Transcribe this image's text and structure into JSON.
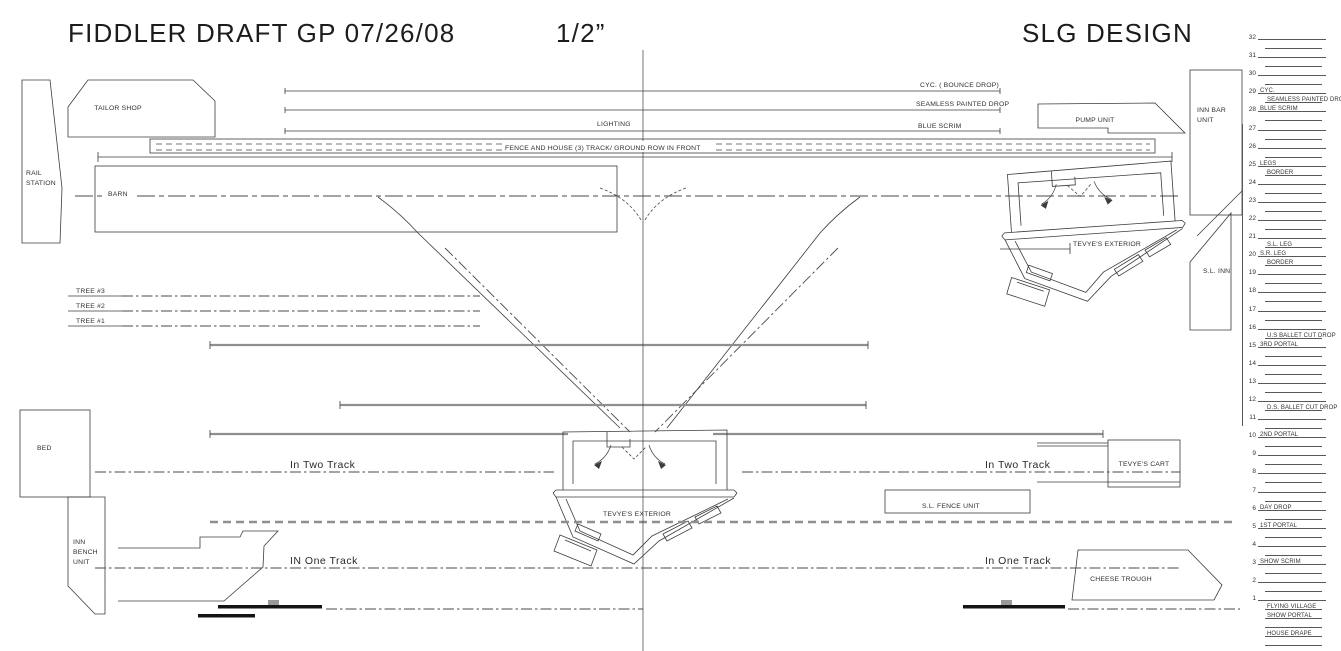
{
  "title_block": {
    "title": "FIDDLER DRAFT GP 07/26/08",
    "scale": "1/2”",
    "designer": "SLG DESIGN"
  },
  "labels": {
    "cyc_bounce_drop": "CYC. ( BOUNCE DROP)",
    "seamless_painted_drop": "SEAMLESS PAINTED DROP",
    "lighting": "LIGHTING",
    "blue_scrim": "BLUE SCRIM",
    "fence_house_track": "FENCE AND HOUSE (3)  TRACK/ GROUND ROW IN FRONT",
    "tailor_shop": "TAILOR SHOP",
    "rail_station_1": "RAIL",
    "rail_station_2": "STATION",
    "barn": "BARN",
    "tree_3": "TREE #3",
    "tree_2": "TREE #2",
    "tree_1": "TREE #1",
    "bed": "BED",
    "inn_bench_1": "INN",
    "inn_bench_2": "BENCH",
    "inn_bench_3": "UNIT",
    "in_two_track_left": "In Two Track",
    "in_two_track_right": "In Two Track",
    "in_one_track_left": "IN One Track",
    "in_one_track_right": "In One Track",
    "pump_unit": "PUMP UNIT",
    "inn_bar_unit_1": "INN BAR",
    "inn_bar_unit_2": "UNIT",
    "sl_inn": "S.L. INN",
    "tevyes_exterior_right": "TEVYE'S EXTERIOR",
    "tevyes_exterior_center": "TEVYE'S EXTERIOR",
    "tevyes_cart": "TEVYE'S CART",
    "sl_fence_unit": "S.L. FENCE UNIT",
    "cheese_trough": "CHEESE TROUGH"
  },
  "lineset_schedule": {
    "items": [
      {
        "n": "32"
      },
      {
        "s": 1
      },
      {
        "n": "31"
      },
      {
        "s": 1
      },
      {
        "n": "30"
      },
      {
        "s": 1
      },
      {
        "n": "29",
        "t": "CYC."
      },
      {
        "s": 1,
        "t": "SEAMLESS PAINTED DROP"
      },
      {
        "n": "28",
        "t": "BLUE SCRIM"
      },
      {
        "s": 1
      },
      {
        "n": "27"
      },
      {
        "s": 1
      },
      {
        "n": "26"
      },
      {
        "s": 1
      },
      {
        "n": "25",
        "t": "LEGS"
      },
      {
        "s": 1,
        "t": "BORDER"
      },
      {
        "n": "24"
      },
      {
        "s": 1
      },
      {
        "n": "23"
      },
      {
        "s": 1
      },
      {
        "n": "22"
      },
      {
        "s": 1
      },
      {
        "n": "21"
      },
      {
        "s": 1,
        "t": "S.L. LEG"
      },
      {
        "n": "20",
        "t": "S.R. LEG"
      },
      {
        "s": 1,
        "t": "BORDER"
      },
      {
        "n": "19"
      },
      {
        "s": 1
      },
      {
        "n": "18"
      },
      {
        "s": 1
      },
      {
        "n": "17"
      },
      {
        "s": 1
      },
      {
        "n": "16"
      },
      {
        "s": 1,
        "t": "U.S BALLET CUT DROP"
      },
      {
        "n": "15",
        "t": "3RD PORTAL"
      },
      {
        "s": 1
      },
      {
        "n": "14"
      },
      {
        "s": 1
      },
      {
        "n": "13"
      },
      {
        "s": 1
      },
      {
        "n": "12"
      },
      {
        "s": 1,
        "t": "D.S. BALLET CUT DROP"
      },
      {
        "n": "11"
      },
      {
        "s": 1
      },
      {
        "n": "10",
        "t": "2ND PORTAL"
      },
      {
        "s": 1
      },
      {
        "n": "9"
      },
      {
        "s": 1
      },
      {
        "n": "8"
      },
      {
        "s": 1
      },
      {
        "n": "7"
      },
      {
        "s": 1
      },
      {
        "n": "6",
        "t": "DAY DROP"
      },
      {
        "s": 1
      },
      {
        "n": "5",
        "t": "1ST PORTAL"
      },
      {
        "s": 1
      },
      {
        "n": "4"
      },
      {
        "s": 1
      },
      {
        "n": "3",
        "t": "SHOW SCRIM"
      },
      {
        "s": 1
      },
      {
        "n": "2"
      },
      {
        "s": 1
      },
      {
        "n": "1"
      },
      {
        "s": 1,
        "t": "FLYING VILLAGE"
      },
      {
        "s": 1,
        "t": "SHOW PORTAL"
      },
      {
        "s": 1
      },
      {
        "s": 1,
        "t": "HOUSE DRAPE"
      },
      {
        "s": 1
      }
    ]
  }
}
